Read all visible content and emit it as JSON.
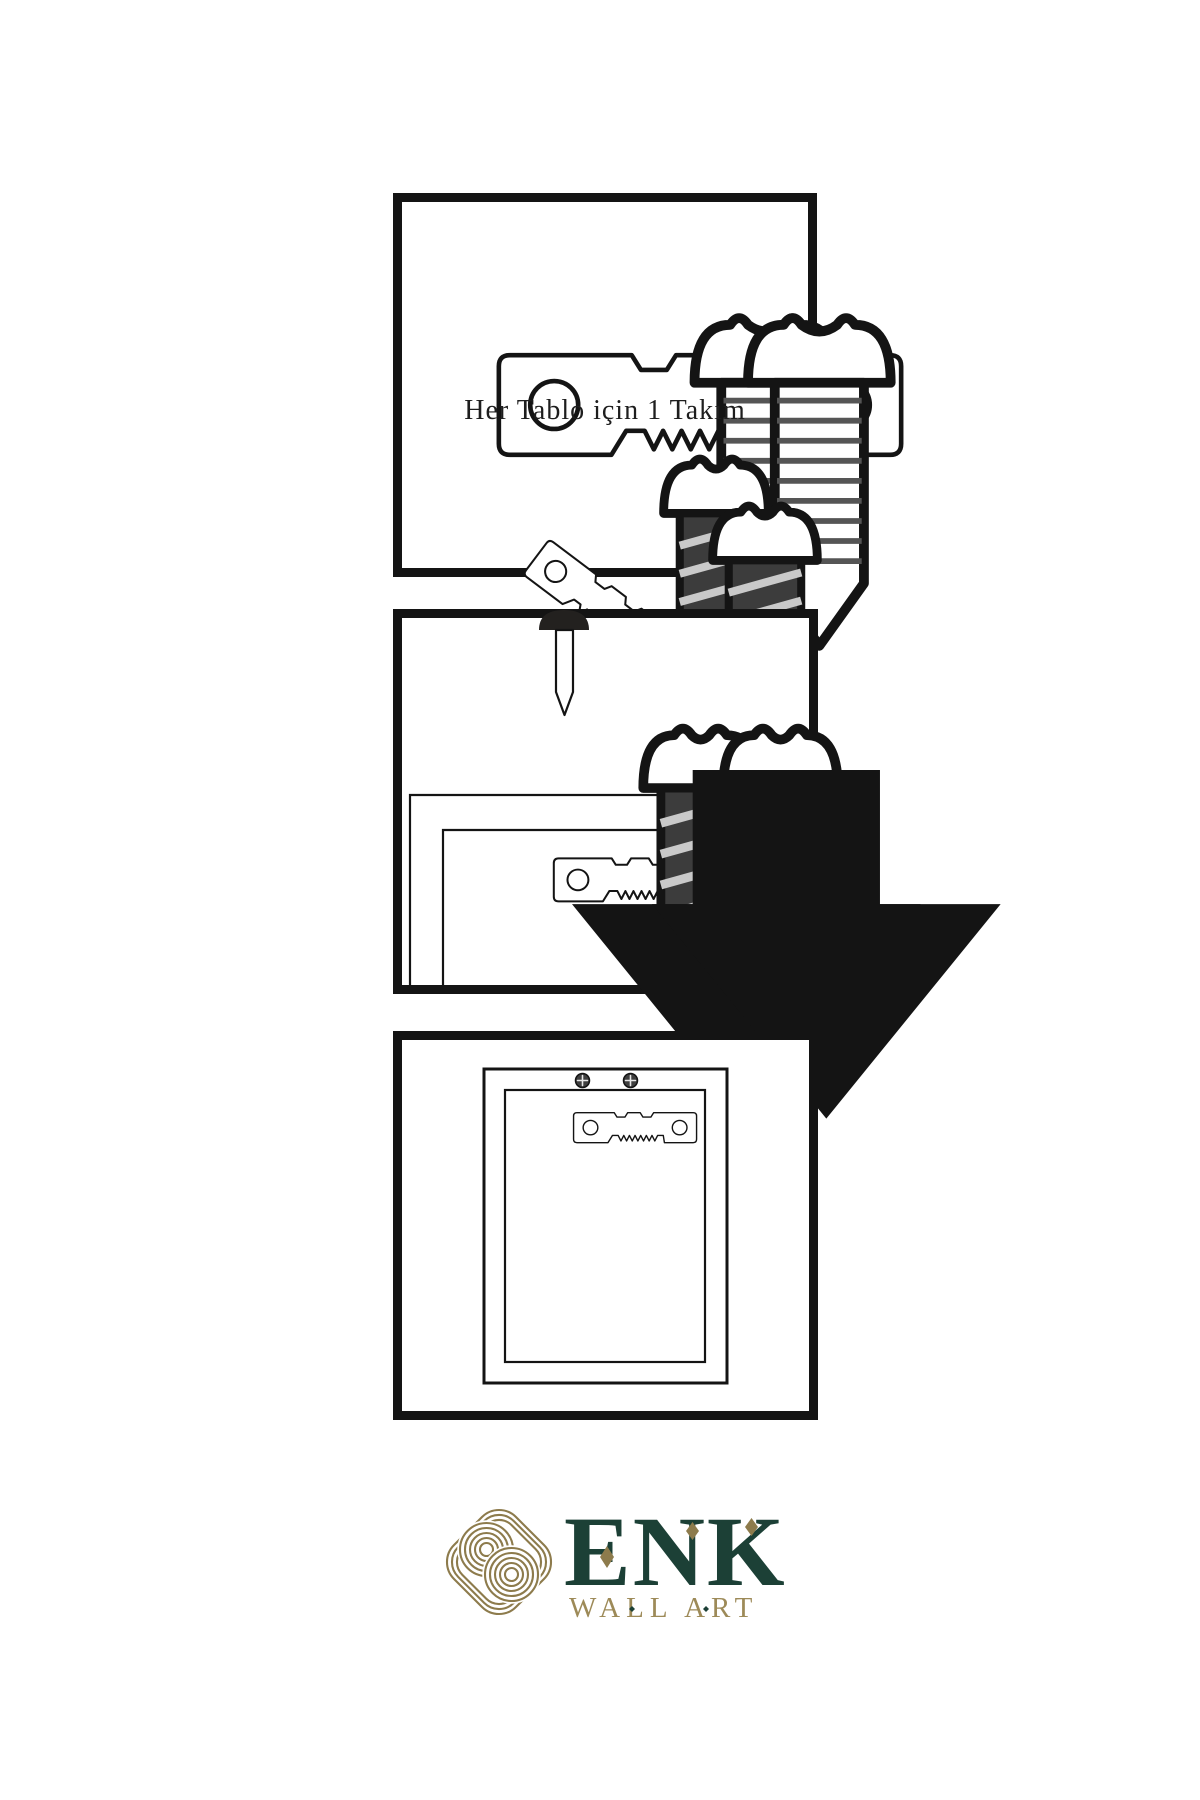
{
  "colors": {
    "ink": "#141414",
    "metal_dark": "#3c3c3c",
    "logo_gold": "#8d7b4c",
    "logo_green": "#1c4036",
    "logo_gold_text": "#9d8a58"
  },
  "steps": [
    {
      "name": "hardware-kit",
      "caption": "Her Tablo için 1 Takım"
    },
    {
      "name": "screw-hanger-to-frame-and-nail-wall"
    },
    {
      "name": "frame-hanging-on-wall"
    }
  ],
  "logo": {
    "title": "ENK",
    "subtitle": "WALL ART"
  },
  "icons": {
    "sawtooth-hanger-icon": "serrated picture-hanger plate with two screw holes",
    "screw-icon": "wood screw, side view, threaded shaft",
    "dark-screw-icon": "wood screw with dark hatched shaft",
    "nail-icon": "nail through wall, point down",
    "arrow-down-icon": "solid black downward arrow",
    "frame-back-icon": "picture frame seen from the back",
    "phillips-screw-head-icon": "installed screw head with cross slot",
    "knot-logo-icon": "interlaced rounded-diamond knot monogram"
  }
}
